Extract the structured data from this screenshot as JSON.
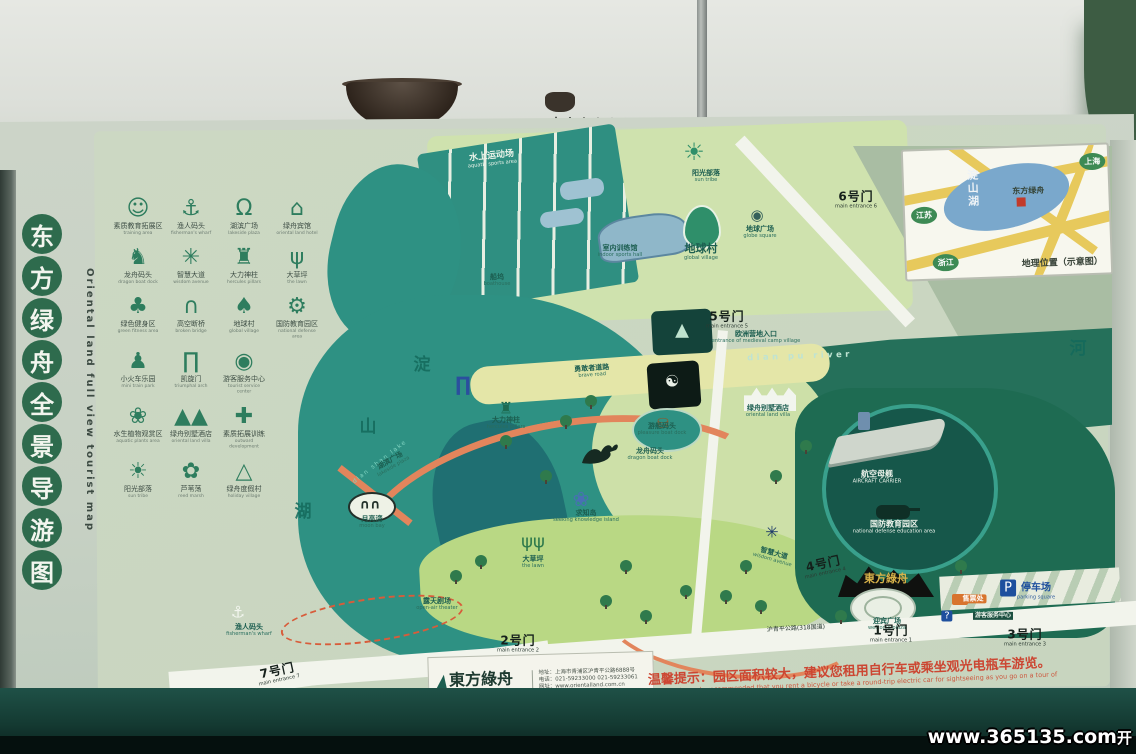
{
  "watermark": {
    "url_text": "www.365135.com",
    "suffix": "开"
  },
  "board": {
    "title": {
      "chars": [
        "东",
        "方",
        "绿",
        "舟",
        "全",
        "景",
        "导",
        "游",
        "图"
      ],
      "en": "Oriental land full view tourist map"
    },
    "legend": {
      "rows": [
        [
          {
            "icon": "mascot-icon",
            "cn": "素质教育拓展区",
            "en": "training area"
          },
          {
            "icon": "wharf-boat-icon",
            "cn": "渔人码头",
            "en": "fisherman's wharf"
          },
          {
            "icon": "plaza-arch-icon",
            "cn": "湖滨广场",
            "en": "lakeside plaza"
          },
          {
            "icon": "hotel-icon",
            "cn": "绿舟宾馆",
            "en": "oriental land hotel"
          }
        ],
        [
          {
            "icon": "dragon-icon",
            "cn": "龙舟码头",
            "en": "dragon boat dock"
          },
          {
            "icon": "knot-icon",
            "cn": "智慧大道",
            "en": "wisdom avenue"
          },
          {
            "icon": "pillars-icon",
            "cn": "大力神柱",
            "en": "hercules pillars"
          },
          {
            "icon": "grass-icon",
            "cn": "大草坪",
            "en": "the lawn"
          }
        ],
        [
          {
            "icon": "clover-figure-icon",
            "cn": "绿色健身区",
            "en": "green fitness area"
          },
          {
            "icon": "bridge-icon",
            "cn": "高空断桥",
            "en": "broken bridge"
          },
          {
            "icon": "drop-icon",
            "cn": "地球村",
            "en": "global village"
          },
          {
            "icon": "vehicle-icon",
            "cn": "国防教育园区",
            "en": "national defense area"
          }
        ],
        [
          {
            "icon": "train-icon",
            "cn": "小火车乐园",
            "en": "mini train park"
          },
          {
            "icon": "arch-gate-icon",
            "cn": "凯旋门",
            "en": "triumphal arch"
          },
          {
            "icon": "camera-icon",
            "cn": "游客服务中心",
            "en": "tourist service center"
          }
        ],
        [
          {
            "icon": "lotus-icon",
            "cn": "水生植物观赏区",
            "en": "aquatic plants area"
          },
          {
            "icon": "tents-icon",
            "cn": "绿舟别墅酒店",
            "en": "oriental land villa"
          },
          {
            "icon": "scarecrow-icon",
            "cn": "素质拓展训练",
            "en": "outward development"
          }
        ],
        [
          {
            "icon": "sun-icon",
            "cn": "阳光部落",
            "en": "sun tribe"
          },
          {
            "icon": "reed-icon",
            "cn": "芦苇荡",
            "en": "reed marsh"
          },
          {
            "icon": "tent-icon",
            "cn": "绿舟度假村",
            "en": "holiday village"
          }
        ]
      ]
    },
    "inset": {
      "caption": "地理位置（示意图）",
      "lake": "淀山湖",
      "site": "东方绿舟",
      "road_label": "沪青平公路(318国道)",
      "regions": [
        {
          "label": "上海",
          "x": 176,
          "y": 8
        },
        {
          "label": "江苏",
          "x": 6,
          "y": 56
        },
        {
          "label": "浙江",
          "x": 26,
          "y": 104
        }
      ]
    },
    "map": {
      "labels": [
        {
          "name": "aquatic-sports-label",
          "cn": "水上运动场",
          "en": "aquatic sports area",
          "x": 492,
          "y": 160,
          "cls": "teal-white",
          "rot": -6
        },
        {
          "name": "boathouse-label",
          "cn": "船坞",
          "en": "boathouse",
          "x": 497,
          "y": 281,
          "cls": "dark-small"
        },
        {
          "name": "indoor-hall-label",
          "cn": "室内训练馆",
          "en": "indoor sports hall",
          "x": 620,
          "y": 252,
          "cls": "dark-small"
        },
        {
          "name": "sun-tribe-label",
          "cn": "阳光部落",
          "en": "sun tribe",
          "x": 706,
          "y": 177,
          "cls": "dark-small"
        },
        {
          "name": "globe-square-label",
          "cn": "地球广场",
          "en": "globe square",
          "x": 760,
          "y": 233,
          "cls": "dark-small"
        },
        {
          "name": "global-village-label",
          "cn": "地球村",
          "en": "global village",
          "x": 701,
          "y": 252,
          "cls": "dark-strong"
        },
        {
          "name": "gate6-label",
          "cn": "6号门",
          "en": "main entrance 6",
          "x": 856,
          "y": 200,
          "cls": "gate"
        },
        {
          "name": "gate5-label",
          "cn": "5号门",
          "en": "main entrance 5",
          "x": 727,
          "y": 320,
          "cls": "gate"
        },
        {
          "name": "camp-entrance-label",
          "cn": "欧洲营地入口",
          "en": "entrance of medieval camp village",
          "x": 756,
          "y": 338,
          "cls": "dark-small"
        },
        {
          "name": "dianpu-river-label",
          "cn": "",
          "en": "dian pu river",
          "x": 800,
          "y": 357,
          "cls": "river",
          "rot": -2
        },
        {
          "name": "river-char-label",
          "cn": "河",
          "en": "",
          "x": 1078,
          "y": 350,
          "cls": "lakechar"
        },
        {
          "name": "brave-road-label",
          "cn": "勇敢者道路",
          "en": "brave road",
          "x": 592,
          "y": 372,
          "cls": "dark-small",
          "rot": -4
        },
        {
          "name": "lake-char-dian",
          "cn": "淀",
          "en": "",
          "x": 422,
          "y": 366,
          "cls": "lakechar"
        },
        {
          "name": "lake-char-shan",
          "cn": "山",
          "en": "",
          "x": 368,
          "y": 428,
          "cls": "lakechar"
        },
        {
          "name": "lake-char-hu",
          "cn": "湖",
          "en": "",
          "x": 303,
          "y": 513,
          "cls": "lakechar"
        },
        {
          "name": "dianshan-lake-en-label",
          "cn": "",
          "en": "dian shan lake",
          "x": 380,
          "y": 462,
          "cls": "lake-en",
          "rot": -38
        },
        {
          "name": "villa-label",
          "cn": "绿舟别墅酒店",
          "en": "oriental land villa",
          "x": 768,
          "y": 412,
          "cls": "dark-small"
        },
        {
          "name": "hercules-label",
          "cn": "大力神柱",
          "en": "hercules pillars",
          "x": 506,
          "y": 424,
          "cls": "dark-small"
        },
        {
          "name": "lakeside-plaza-label",
          "cn": "湖滨广场",
          "en": "lakeside plaza",
          "x": 392,
          "y": 464,
          "cls": "dark-small",
          "rot": -30
        },
        {
          "name": "ferry-dock-label",
          "cn": "游船码头",
          "en": "pleasure boat dock",
          "x": 662,
          "y": 430,
          "cls": "dark-small"
        },
        {
          "name": "dragon-dock-label",
          "cn": "龙舟码头",
          "en": "dragon boat dock",
          "x": 650,
          "y": 455,
          "cls": "dark-small"
        },
        {
          "name": "moon-bay-label",
          "cn": "月亮湾",
          "en": "moon bay",
          "x": 372,
          "y": 523,
          "cls": "dark-small"
        },
        {
          "name": "knowledge-island-label",
          "cn": "求知岛",
          "en": "seeking knowledge island",
          "x": 586,
          "y": 517,
          "cls": "dark-small"
        },
        {
          "name": "wisdom-avenue-label",
          "cn": "智慧大道",
          "en": "wisdom avenue",
          "x": 773,
          "y": 557,
          "cls": "dark-small",
          "rot": 16
        },
        {
          "name": "lawn-label",
          "cn": "大草坪",
          "en": "the lawn",
          "x": 533,
          "y": 563,
          "cls": "dark-small"
        },
        {
          "name": "theater-label",
          "cn": "露天剧场",
          "en": "open-air theater",
          "x": 437,
          "y": 605,
          "cls": "dark-small"
        },
        {
          "name": "fisherman-wharf-label",
          "cn": "渔人码头",
          "en": "fisherman's wharf",
          "x": 249,
          "y": 631,
          "cls": "dark-small"
        },
        {
          "name": "carrier-label",
          "cn": "航空母舰",
          "en": "AIRCRAFT CARRIER",
          "x": 877,
          "y": 478,
          "cls": "white-small"
        },
        {
          "name": "defense-label",
          "cn": "国防教育园区",
          "en": "national defense education area",
          "x": 894,
          "y": 528,
          "cls": "white-small"
        },
        {
          "name": "gate4-label",
          "cn": "4号门",
          "en": "main entrance 4",
          "x": 824,
          "y": 567,
          "cls": "gate",
          "rot": -12
        },
        {
          "name": "oriental-sign-label",
          "cn": "東方綠舟",
          "en": "",
          "x": 886,
          "y": 579,
          "cls": "gold"
        },
        {
          "name": "fountain-plaza-label",
          "cn": "迎宾广场",
          "en": "welcome plaza",
          "x": 887,
          "y": 625,
          "cls": "dark-small"
        },
        {
          "name": "parking-label",
          "cn": "停车场",
          "en": "parking square",
          "x": 1036,
          "y": 592,
          "cls": "parking"
        },
        {
          "name": "ticket-office-label",
          "cn": "售票处",
          "en": "",
          "x": 973,
          "y": 599,
          "cls": "ticket"
        },
        {
          "name": "tourist-center-label",
          "cn": "游客服务中心",
          "en": "",
          "x": 993,
          "y": 616,
          "cls": "white-tiny"
        },
        {
          "name": "gate2-label",
          "cn": "2号门",
          "en": "main entrance 2",
          "x": 518,
          "y": 644,
          "cls": "gate"
        },
        {
          "name": "gate1-label",
          "cn": "1号门",
          "en": "main entrance 1",
          "x": 891,
          "y": 634,
          "cls": "gate"
        },
        {
          "name": "gate3-label",
          "cn": "3号门",
          "en": "main entrance 3",
          "x": 1025,
          "y": 638,
          "cls": "gate"
        },
        {
          "name": "gate7-label",
          "cn": "7号门",
          "en": "main entrance 7",
          "x": 278,
          "y": 674,
          "cls": "gate",
          "rot": -12
        },
        {
          "name": "highway-label",
          "cn": "沪青平公路(318国道)",
          "en": "",
          "x": 796,
          "y": 629,
          "cls": "tiny-dark",
          "rot": -3
        }
      ],
      "parking_badge": "P"
    },
    "footer": {
      "logo_cn": "東方綠舟",
      "logo_en": "ORIENTAL LAND",
      "addr_rows": [
        "地址：上海市青浦区沪青平公路6888号",
        "电话：021-59233000  021-59233061",
        "网址：www.orientalland.com.cn"
      ],
      "tips_cn": "温馨提示：园区面积较大，建议您租用自行车或乘坐观光电瓶车游览。",
      "tips_en": "tips: It's sincerely recommended that you rent a bicycle or take a round-trip electric car for sightseeing as you go on a tour of such an extensive area."
    }
  }
}
